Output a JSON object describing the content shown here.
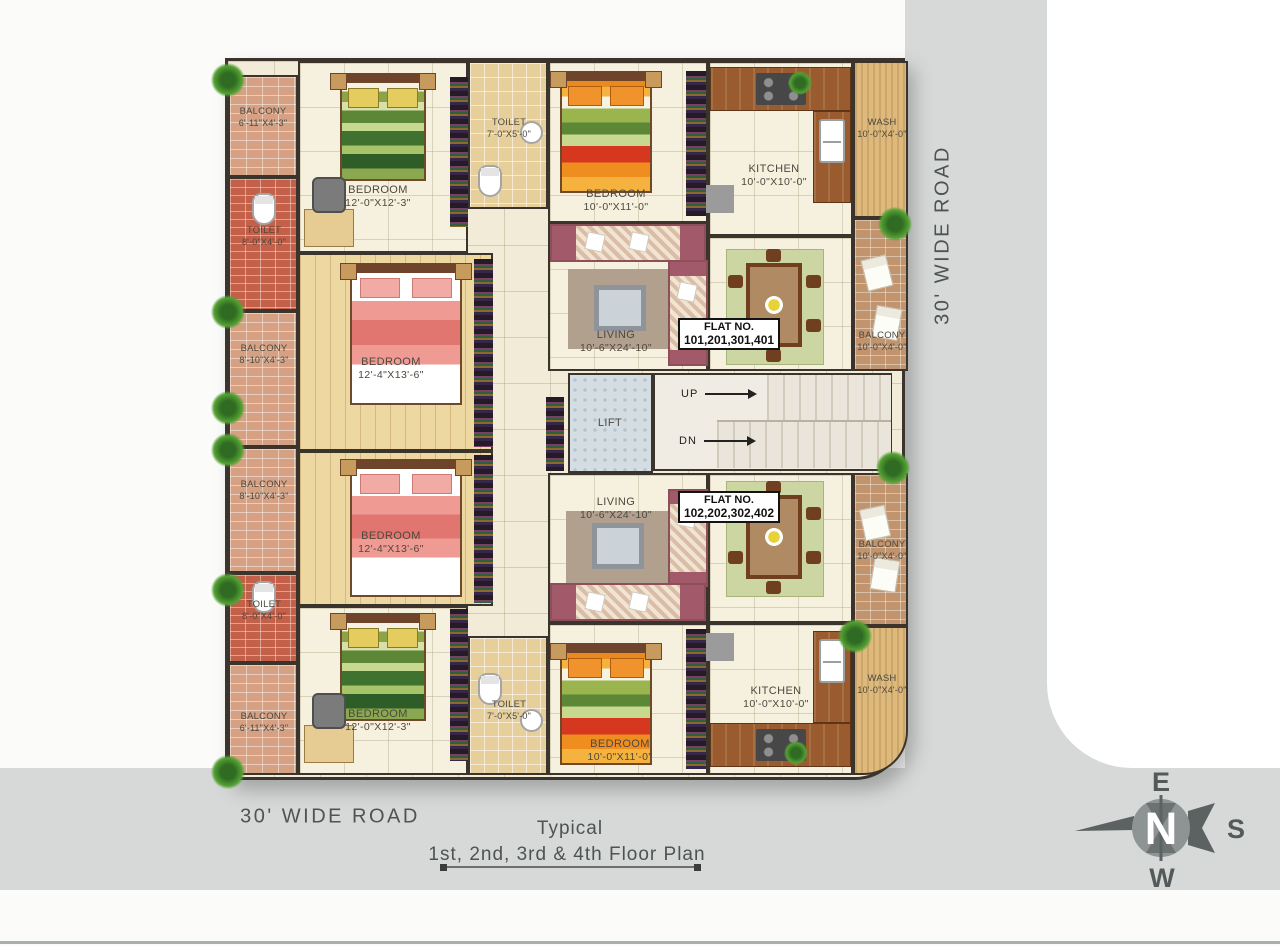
{
  "page": {
    "road_right": "30' WIDE ROAD",
    "road_bottom": "30' WIDE ROAD",
    "caption_line1": "Typical",
    "caption_line2": "1st, 2nd, 3rd & 4th Floor Plan"
  },
  "compass": {
    "north": "N",
    "east": "E",
    "south": "S",
    "west": "W"
  },
  "core": {
    "lift": "LIFT",
    "up": "UP",
    "down": "DN"
  },
  "flat1": {
    "label": "FLAT NO.",
    "numbers": "101,201,301,401"
  },
  "flat2": {
    "label": "FLAT NO.",
    "numbers": "102,202,302,402"
  },
  "rooms": {
    "balcony_tl": {
      "name": "BALCONY",
      "size": "6'-11\"X4'-3\""
    },
    "toilet_l1": {
      "name": "TOILET",
      "size": "8'-0\"X4'-0\""
    },
    "balcony_l2": {
      "name": "BALCONY",
      "size": "8'-10\"X4'-3\""
    },
    "balcony_l3": {
      "name": "BALCONY",
      "size": "8'-10\"X4'-3\""
    },
    "toilet_l2": {
      "name": "TOILET",
      "size": "8'-0\"X4'-0\""
    },
    "balcony_bl": {
      "name": "BALCONY",
      "size": "6'-11\"X4'-3\""
    },
    "bedroom_tl": {
      "name": "BEDROOM",
      "size": "12'-0\"X12'-3\""
    },
    "toilet_t": {
      "name": "TOILET",
      "size": "7'-0\"X5'-0\""
    },
    "bedroom_m1": {
      "name": "BEDROOM",
      "size": "12'-4\"X13'-6\""
    },
    "bedroom_tm": {
      "name": "BEDROOM",
      "size": "10'-0\"X11'-0\""
    },
    "kitchen_t": {
      "name": "KITCHEN",
      "size": "10'-0\"X10'-0\""
    },
    "wash_t": {
      "name": "WASH",
      "size": "10'-0\"X4'-0\""
    },
    "living1": {
      "name": "LIVING",
      "size": "10'-6\"X24'-10\""
    },
    "balcony_r1": {
      "name": "BALCONY",
      "size": "10'-0\"X4'-0\""
    },
    "living2": {
      "name": "LIVING",
      "size": "10'-6\"X24'-10\""
    },
    "balcony_r2": {
      "name": "BALCONY",
      "size": "10'-0\"X4'-0\""
    },
    "bedroom_m2": {
      "name": "BEDROOM",
      "size": "12'-4\"X13'-6\""
    },
    "bedroom_bl": {
      "name": "BEDROOM",
      "size": "12'-0\"X12'-3\""
    },
    "toilet_b": {
      "name": "TOILET",
      "size": "7'-0\"X5'-0\""
    },
    "bedroom_bm": {
      "name": "BEDROOM",
      "size": "10'-0\"X11'-0\""
    },
    "kitchen_b": {
      "name": "KITCHEN",
      "size": "10'-0\"X10'-0\""
    },
    "wash_b": {
      "name": "WASH",
      "size": "10'-0\"X4'-0\""
    }
  },
  "colors": {
    "road_gray": "#d6d9d8",
    "wall_dark": "#3a342c",
    "floor_cream": "#f2ebd7",
    "floor_wood": "#edd8a1",
    "brick_red": "#c2604a",
    "brick_tan": "#d6a182",
    "counter_wood": "#9a5c2e",
    "sofa_maroon": "#a2596a",
    "compass_gray": "#5c6161"
  }
}
